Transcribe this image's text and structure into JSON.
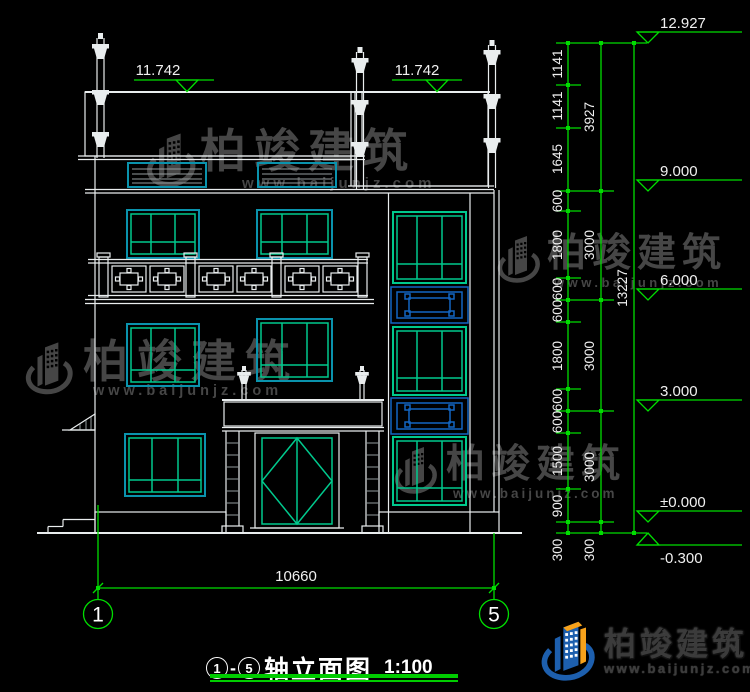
{
  "drawing": {
    "title": {
      "axis_start": "1",
      "separator": "-",
      "axis_end": "5",
      "name": "轴立面图",
      "scale": "1:100"
    },
    "axes": {
      "left": "1",
      "right": "5"
    },
    "dimensions": {
      "overall_width": "10660",
      "eave_left": "11.742",
      "eave_right": "11.742",
      "chain_inner": [
        "1141",
        "1141",
        "1645",
        "600",
        "1800",
        "600",
        "600",
        "1800",
        "600",
        "600",
        "1500",
        "900",
        "300"
      ],
      "chain_mid": [
        "3927",
        "3000",
        "3000",
        "3000",
        "300"
      ],
      "chain_total": "13227",
      "levels": [
        "12.927",
        "9.000",
        "6.000",
        "3.000",
        "±0.000",
        "-0.300"
      ]
    }
  },
  "watermark": {
    "brand": "柏竣建筑",
    "url": "www.baijunjz.com"
  },
  "logo": {
    "brand": "柏竣建筑",
    "url": "www.baijunjz.com"
  },
  "colors": {
    "background": "#000000",
    "line_white": "#e9edee",
    "dimension_green": "#00dd00",
    "window_frame_cyan": "#0a93ad",
    "window_mullion_green": "#00c98d",
    "lattice_blue": "#1266c2",
    "watermark_gray": "#4a4a4a",
    "logo_blue": "#1d5fae",
    "logo_orange": "#f7a21b"
  }
}
